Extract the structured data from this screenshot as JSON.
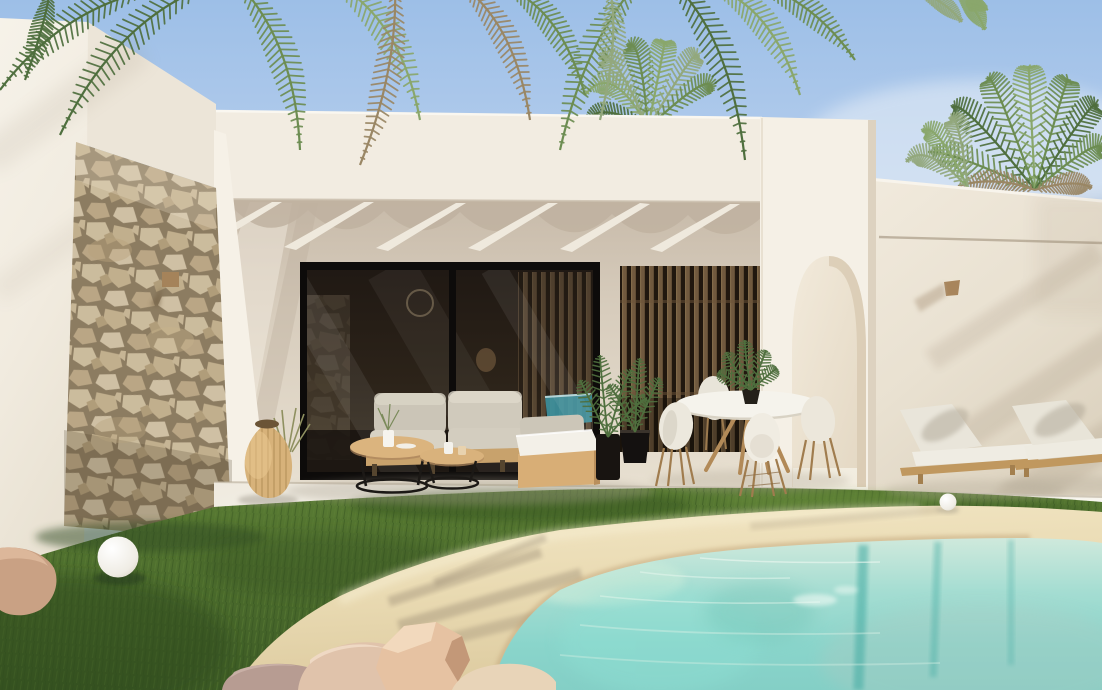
{
  "page": {
    "title": "Modern villa exterior with pergola terrace, lawn and lagoon pool"
  },
  "labels": {
    "scene": "photorealistic render of a white modern villa with terrace, lawn and pool",
    "sky": "clear light-blue sky",
    "palm_canopy": "palm fronds hanging from the top of the frame",
    "palm_crowns": "palm tree crowns behind the roof line",
    "villa": "white flat-roofed villa",
    "left_wing": "tall white wall volume on the left",
    "stone_pillar": "natural stone clad pillar",
    "stone_wall_lamp": "small wooden wall lamp on the stone pillar",
    "parapet": "white roof parapet band",
    "pergola": "roof overhang with white rafters and scalloped shadows",
    "glass_doors": "black framed sliding glass doors",
    "glass_pool_reflection": "turquoise pool reflection in the glass",
    "slat_screen": "vertical wooden slat screen",
    "arch_wall": "white wall with arched opening",
    "arch_opening": "arched passage",
    "right_wing": "white garden wall on the right with palm shadows",
    "wall_groove": "horizontal shadow groove on the right wall",
    "right_wall_lamp": "small wooden wall lamp on the right wall",
    "terrace": "bright terrace floor",
    "outdoor_sofa": "outdoor sofa with grey cushions",
    "chaise": "chaise module with white cushion on wooden box",
    "coffee_tables": "two round nesting coffee tables with black wire bases",
    "table_vase": "white vase with sprigs on the coffee table",
    "table_cup": "white cup and candle on the small table",
    "vase_lamp": "rattan teardrop floor lantern",
    "ornamental_grass": "ornamental grass tuft",
    "ball_lamp": "white sphere garden lamp on the lawn",
    "planters": "black planters with green palms",
    "dining_set": "round white dining table with four white shell chairs",
    "dining_plant": "potted plant on the dining table",
    "loungers": "two wooden sun loungers with white cushions",
    "pebble": "small white pebble sphere by the loungers",
    "lawn": "green lawn",
    "sand_beach": "sandy beach-style pool surround",
    "pool": "turquoise lagoon pool with palm reflections",
    "rocks": "decorative boulders by the pool",
    "left_rock": "small boulder at the left lawn edge"
  },
  "palette": {
    "sky_top": "#9dbfe7",
    "sky_horizon": "#e6eef8",
    "wall_bright": "#f6f1e7",
    "wall_warm": "#efe8db",
    "wall_shade": "#d9cebd",
    "soffit": "#c9bcab",
    "stone_light": "#e2d3b2",
    "stone_mid": "#d6c49f",
    "stone_grout": "#8f7f63",
    "glass_dark": "#241d17",
    "frame_black": "#0d0b0a",
    "slat_wood": "#8d7150",
    "slat_gap": "#221910",
    "grass_dark": "#3a5a26",
    "grass_mid": "#4e7030",
    "grass_light": "#65883a",
    "sand": "#e9dab2",
    "sand_shadow": "#c9b288",
    "water_shallow": "#cfe9dd",
    "water_mid": "#9fdcd2",
    "water_deep": "#7fd0c8",
    "water_streak": "#4cafa6",
    "cushion_grey": "#cbc5b7",
    "cushion_white": "#f3f0e8",
    "wood_light": "#d8ae76",
    "wood_frame": "#c8a26c",
    "wire_black": "#1c1916",
    "rattan": "#d7b27a",
    "rock_pink": "#e3bfa2",
    "rock_tan": "#d9c3a6",
    "leaf_dark": "#4f6f3e",
    "leaf_mid": "#6d8d52",
    "leaf_light": "#8aa76c",
    "leaf_sage": "#93a87d",
    "leaf_brown": "#9a8765"
  }
}
